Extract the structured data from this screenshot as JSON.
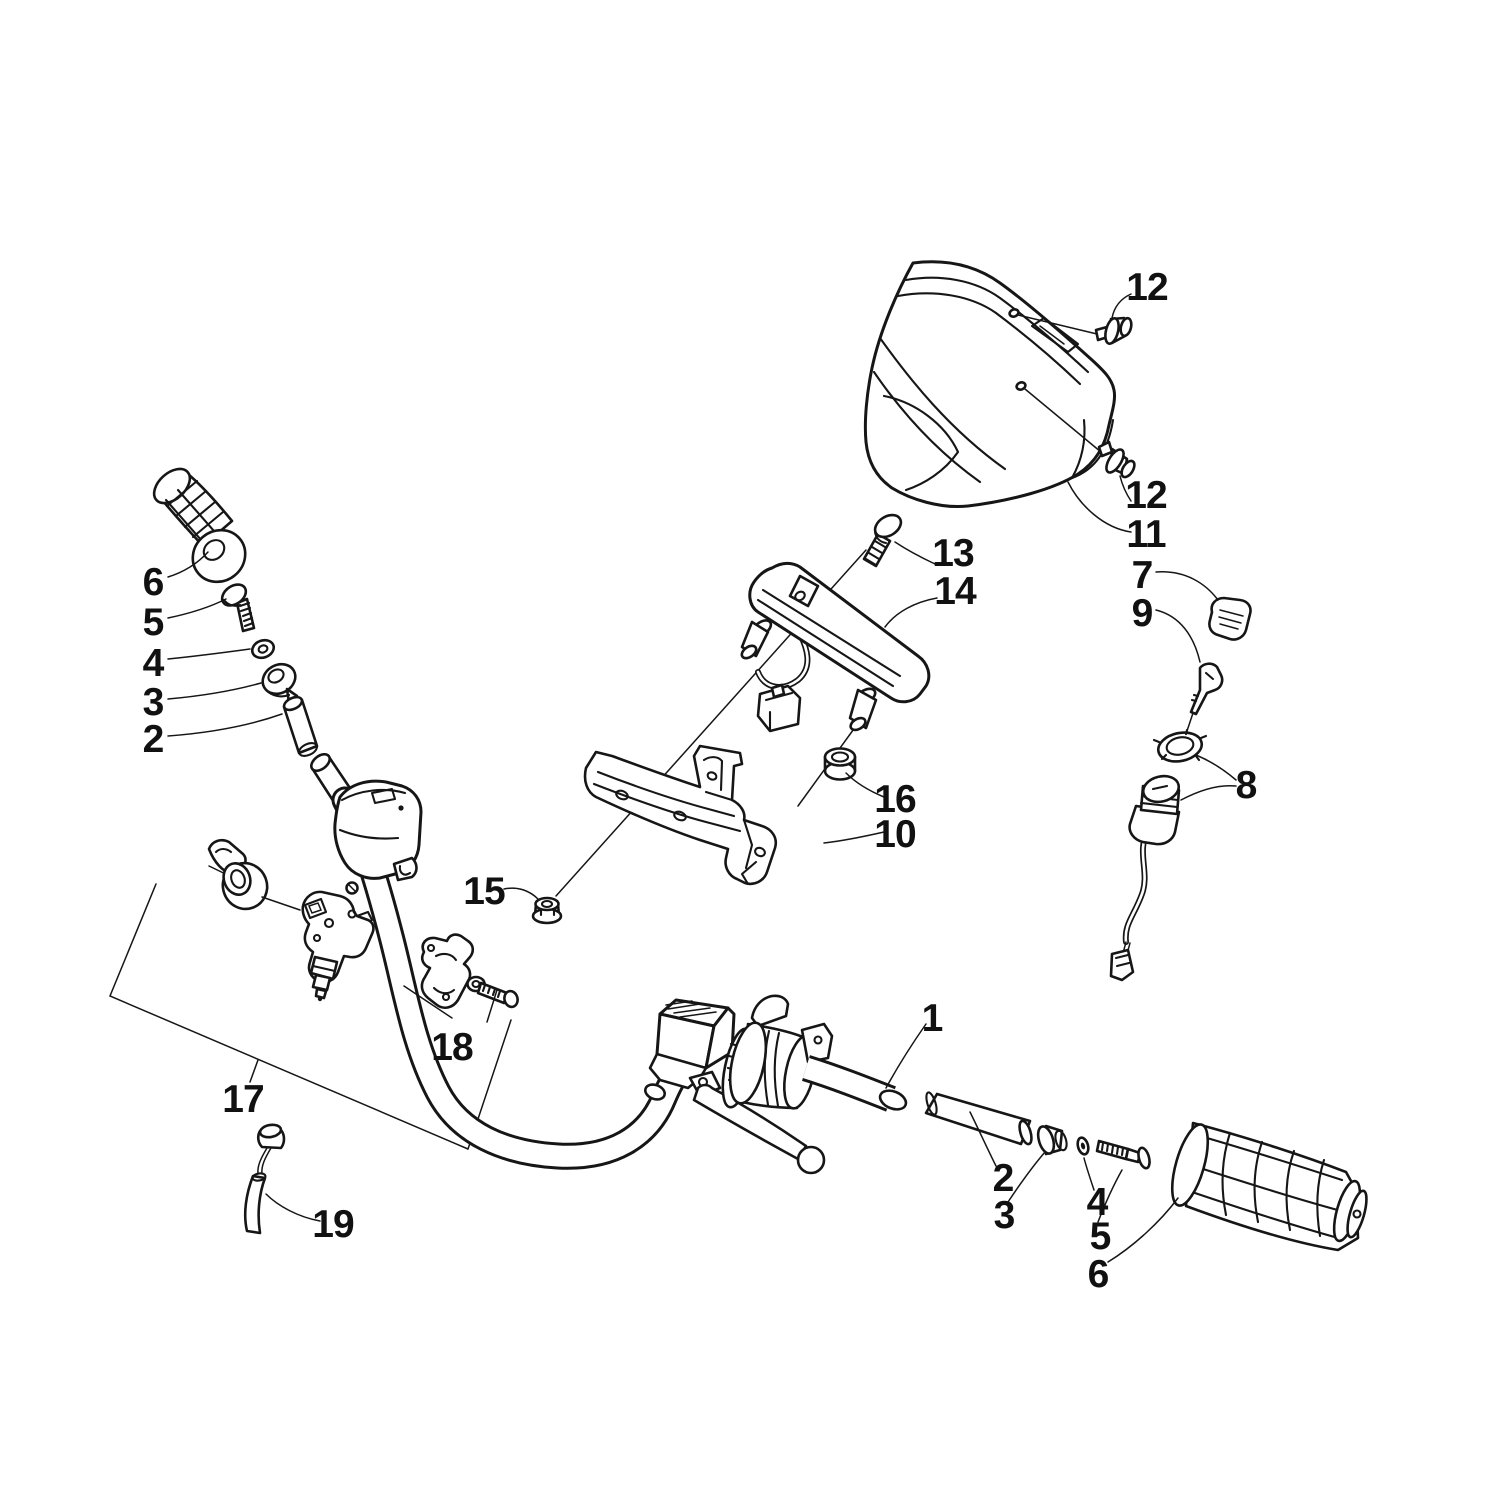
{
  "diagram": {
    "kind": "exploded-parts-diagram",
    "subject": "ATV handlebar, controls, gauge and headlight pod assembly",
    "style": {
      "background": "#ffffff",
      "line_color": "#161616",
      "label_color": "#111111"
    },
    "callouts": [
      {
        "label": "6",
        "part": "left-handlebar-grip"
      },
      {
        "label": "5",
        "part": "left-grip-end-screw"
      },
      {
        "label": "4",
        "part": "left-grip-end-washer"
      },
      {
        "label": "3",
        "part": "left-bar-end-cap"
      },
      {
        "label": "2",
        "part": "left-bar-end-tube"
      },
      {
        "label": "12",
        "part": "headlight-pod-rivet-upper"
      },
      {
        "label": "12",
        "part": "headlight-pod-rivet-lower"
      },
      {
        "label": "11",
        "part": "headlight-pod-cover"
      },
      {
        "label": "13",
        "part": "gauge-mounting-bolt"
      },
      {
        "label": "14",
        "part": "gauge-assembly"
      },
      {
        "label": "7",
        "part": "key-fob"
      },
      {
        "label": "9",
        "part": "ignition-key"
      },
      {
        "label": "16",
        "part": "gauge-mount-grommet"
      },
      {
        "label": "10",
        "part": "gauge-mounting-bracket"
      },
      {
        "label": "8",
        "part": "ignition-switch-with-ring"
      },
      {
        "label": "15",
        "part": "flange-nut"
      },
      {
        "label": "18",
        "part": "handlebar-clamp-kit"
      },
      {
        "label": "17",
        "part": "handlebar-assembly"
      },
      {
        "label": "19",
        "part": "cable-boot"
      },
      {
        "label": "1",
        "part": "handlebar-tube"
      },
      {
        "label": "2",
        "part": "right-bar-end-tube"
      },
      {
        "label": "3",
        "part": "right-bar-end-cap"
      },
      {
        "label": "4",
        "part": "right-grip-end-washer"
      },
      {
        "label": "5",
        "part": "right-grip-end-screw"
      },
      {
        "label": "6",
        "part": "right-handlebar-grip"
      }
    ]
  }
}
